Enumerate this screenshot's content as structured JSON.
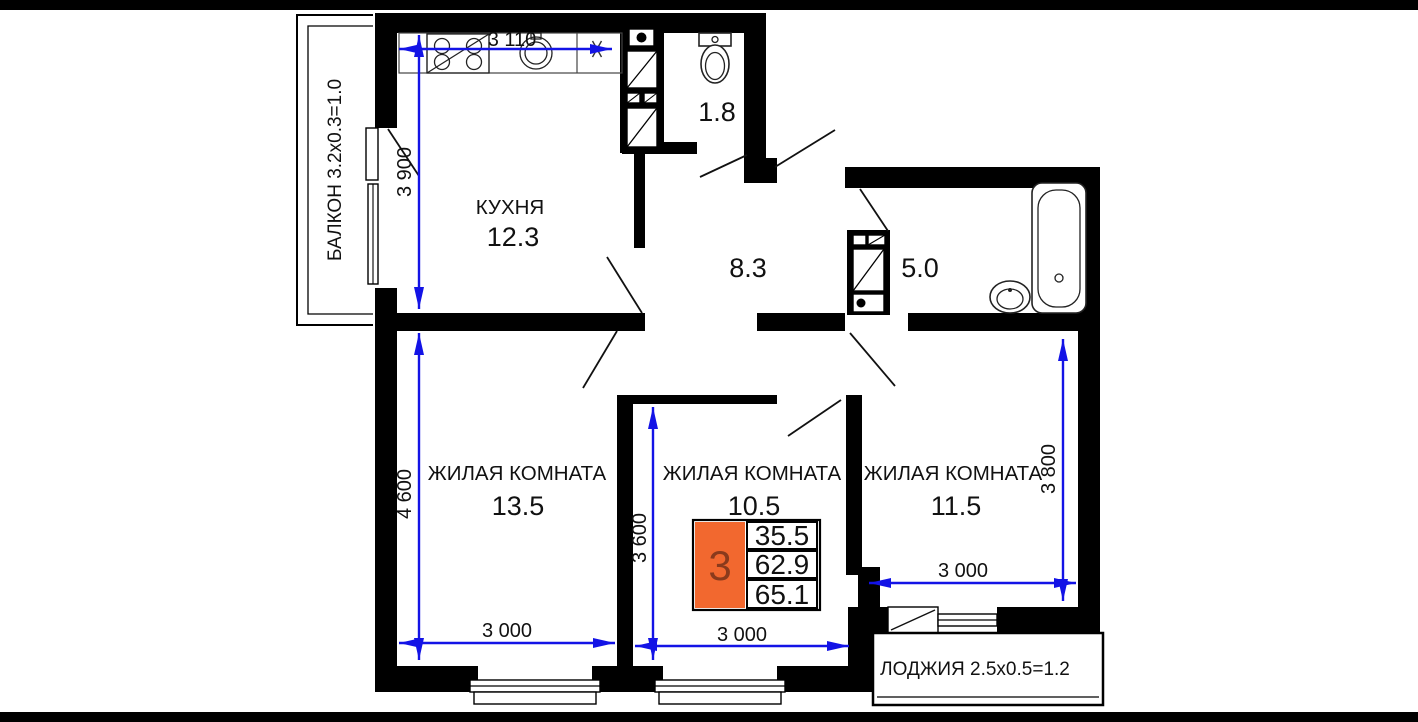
{
  "colors": {
    "wall": "#000000",
    "dimension_line": "#1313e6",
    "table_highlight_orange": "#f2682f",
    "room_count_digit": "#8a3a1c",
    "background": "#ffffff",
    "frame_bars": "#000000"
  },
  "balcony": {
    "label": "БАЛКОН 3.2x0.3=1.0"
  },
  "loggia": {
    "label": "ЛОДЖИЯ 2.5x0.5=1.2"
  },
  "rooms": {
    "kitchen": {
      "name": "КУХНЯ",
      "area": "12.3"
    },
    "wc": {
      "area": "1.8"
    },
    "hallway": {
      "area": "8.3"
    },
    "bathroom": {
      "area": "5.0"
    },
    "living_left": {
      "name": "ЖИЛАЯ КОМНАТА",
      "area": "13.5"
    },
    "living_middle": {
      "name": "ЖИЛАЯ КОМНАТА",
      "area": "10.5"
    },
    "living_right": {
      "name": "ЖИЛАЯ КОМНАТА",
      "area": "11.5"
    }
  },
  "dimensions": {
    "kitchen_width": "3 110",
    "kitchen_depth": "3 900",
    "living_left_depth": "4 600",
    "living_left_width": "3 000",
    "living_middle_depth": "3 600",
    "living_middle_width": "3 000",
    "living_right_depth": "3 800",
    "living_right_width": "3 000"
  },
  "summary_table": {
    "room_count": "3",
    "living_area": "35.5",
    "apartment_area": "62.9",
    "total_area": "65.1"
  }
}
